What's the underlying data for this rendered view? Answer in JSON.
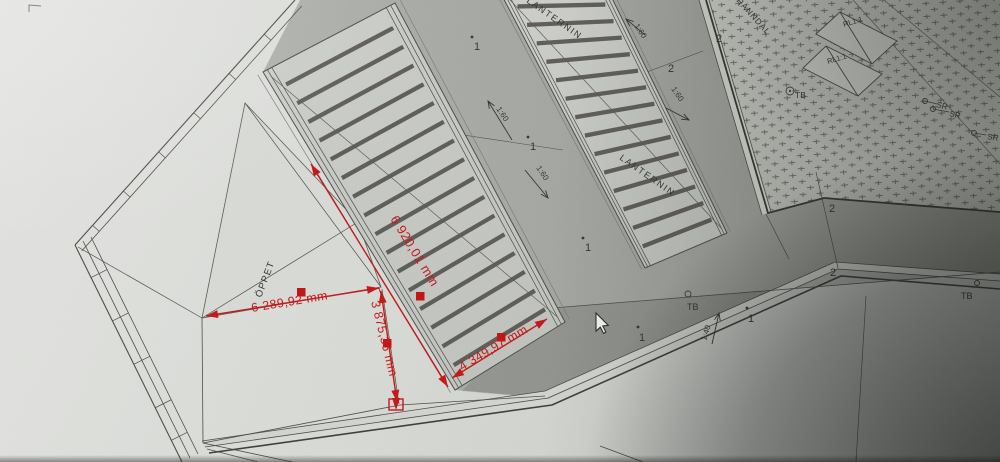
{
  "labels": {
    "oppet": "ÖPPET",
    "lanternin": "LANTERNIN",
    "ranndal": "RÄNNDAL",
    "rl": "RL1:1",
    "tb": "TB",
    "sr": "SR"
  },
  "dimensions": {
    "open_width": "6 289,92 mm",
    "skylight_length": "6 920,01 mm",
    "strip_width": "3 875,36 mm",
    "skylight_width": "4 349,97 mm"
  },
  "slopes": {
    "one_sixty": "1:60",
    "one_forty": "1:40"
  },
  "markers": {
    "one": "1",
    "two": "2"
  },
  "colors": {
    "dimension_red": "#c81616",
    "linework": "#4b4c46",
    "deck_gray": "#9fa19c",
    "paper": "#d8dad6"
  }
}
